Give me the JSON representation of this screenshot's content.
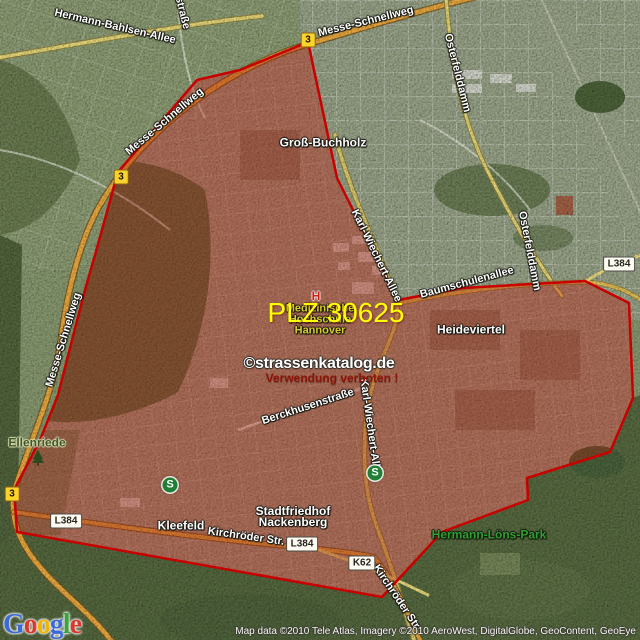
{
  "colors": {
    "boundary": "#c80000",
    "overlay_fill": "rgba(178,28,10,0.36)",
    "plz_text": "#ffff00",
    "bundesstrasse_badge": "#fcd32b",
    "landesstrasse_badge": "#fdfaf2"
  },
  "overlay": {
    "plz_label": "PLZ 30625"
  },
  "watermark": {
    "brand": "©strassenkatalog.de",
    "notice": "Verwendung verboten !"
  },
  "attribution": {
    "text": "Map data ©2010 Tele Atlas, Imagery ©2010 AeroWest, DigitalGlobe, GeoContent, GeoEye"
  },
  "google_logo": {
    "text": "Google",
    "letters": [
      "G",
      "o",
      "o",
      "g",
      "l",
      "e"
    ],
    "letter_colors": [
      "#3b6ad6",
      "#d8382e",
      "#f0b400",
      "#3b6ad6",
      "#3aa33a",
      "#d8382e"
    ]
  },
  "street_labels": [
    {
      "text": "Hermann-Bahlsen-Allee",
      "x": 115,
      "y": 27,
      "rot": 13
    },
    {
      "text": "straße",
      "x": 182,
      "y": 13,
      "rot": 76
    },
    {
      "text": "Messe-Schnellweg",
      "x": 366,
      "y": 22,
      "rot": -14
    },
    {
      "text": "Messe-Schnellweg",
      "x": 165,
      "y": 122,
      "rot": -40
    },
    {
      "text": "Messe-Schnellweg",
      "x": 64,
      "y": 340,
      "rot": -73
    },
    {
      "text": "Osterfelddamm",
      "x": 457,
      "y": 73,
      "rot": 76
    },
    {
      "text": "Osterfelddamm",
      "x": 529,
      "y": 251,
      "rot": 79
    },
    {
      "text": "Karl-Wiechert-Allee",
      "x": 376,
      "y": 256,
      "rot": 64
    },
    {
      "text": "Karl-Wiechert-Allee",
      "x": 370,
      "y": 429,
      "rot": 82
    },
    {
      "text": "Berckhusenstraße",
      "x": 308,
      "y": 407,
      "rot": -18
    },
    {
      "text": "Kirchröder Str.",
      "x": 246,
      "y": 537,
      "rot": 8
    },
    {
      "text": "Kirchröder Str",
      "x": 396,
      "y": 597,
      "rot": 56
    },
    {
      "text": "Baumschulenallee",
      "x": 467,
      "y": 283,
      "rot": -15
    }
  ],
  "place_labels": [
    {
      "lines": [
        "Groß-Buchholz"
      ],
      "x": 323,
      "y": 143,
      "size": 12,
      "color": "#ffffff",
      "halo": "dark"
    },
    {
      "lines": [
        "Heideviertel"
      ],
      "x": 471,
      "y": 330,
      "size": 12,
      "color": "#ffffff",
      "halo": "dark"
    },
    {
      "lines": [
        "Kleefeld"
      ],
      "x": 181,
      "y": 526,
      "size": 12,
      "color": "#ffffff",
      "halo": "dark"
    },
    {
      "lines": [
        "Stadtfriedhof",
        "Nackenberg"
      ],
      "x": 293,
      "y": 517,
      "size": 12,
      "color": "#ffffff",
      "halo": "dark"
    },
    {
      "lines": [
        "Hermann-Löns-Park"
      ],
      "x": 489,
      "y": 535,
      "size": 12,
      "color": "#2fa12f",
      "halo": "dark"
    },
    {
      "lines": [
        "Ellenriede"
      ],
      "x": 37,
      "y": 443,
      "size": 12,
      "color": "#42551f",
      "halo": "light"
    },
    {
      "lines": [
        "Medizinische",
        "Hochschule",
        "Hannover"
      ],
      "x": 320,
      "y": 320,
      "size": 11,
      "color": "#d8cc2e",
      "halo": "dark"
    }
  ],
  "road_badges": [
    {
      "text": "3",
      "style": "b",
      "x": 308,
      "y": 40
    },
    {
      "text": "3",
      "style": "b",
      "x": 121,
      "y": 177
    },
    {
      "text": "3",
      "style": "b",
      "x": 12,
      "y": 494
    },
    {
      "text": "L384",
      "style": "l",
      "x": 66,
      "y": 521
    },
    {
      "text": "L384",
      "style": "l",
      "x": 302,
      "y": 544
    },
    {
      "text": "K62",
      "style": "l",
      "x": 362,
      "y": 563
    },
    {
      "text": "L384",
      "style": "l",
      "x": 619,
      "y": 264
    }
  ],
  "map_icons": [
    {
      "type": "sbahn",
      "glyph": "S",
      "x": 170,
      "y": 485
    },
    {
      "type": "sbahn",
      "glyph": "S",
      "x": 375,
      "y": 473
    },
    {
      "type": "hospital",
      "glyph": "H",
      "x": 316,
      "y": 296
    },
    {
      "type": "tree",
      "glyph": "",
      "x": 38,
      "y": 458
    }
  ]
}
